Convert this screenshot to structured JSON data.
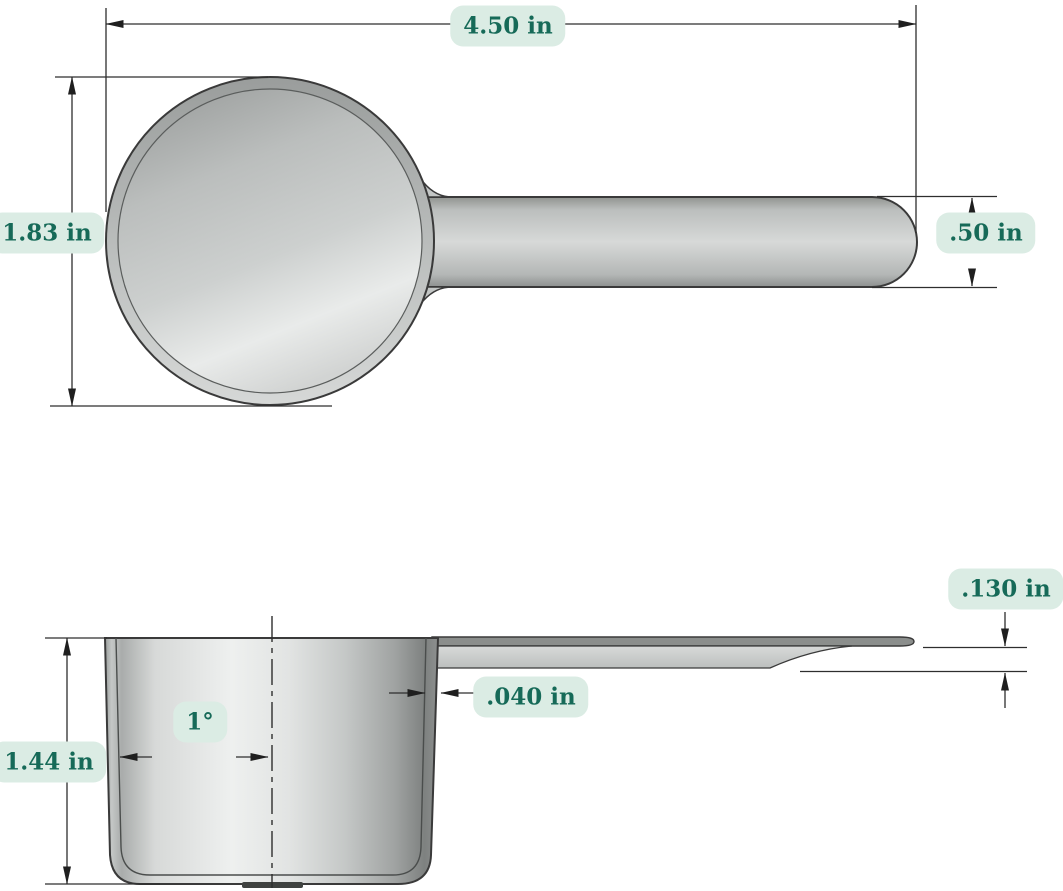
{
  "drawing": {
    "dimensions": {
      "overall_length": "4.50 in",
      "bowl_outer_diameter": "1.83 in",
      "handle_width": ".50 in",
      "handle_thickness": ".130 in",
      "wall_thickness": ".040 in",
      "bowl_height": "1.44 in",
      "draft_angle": "1°"
    },
    "colors": {
      "label_background": "#dbece4",
      "label_text": "#166a58",
      "dimension_line": "#2e2e2e",
      "part_outline": "#3a3a3a",
      "part_gray": "#c6c9c8"
    }
  }
}
